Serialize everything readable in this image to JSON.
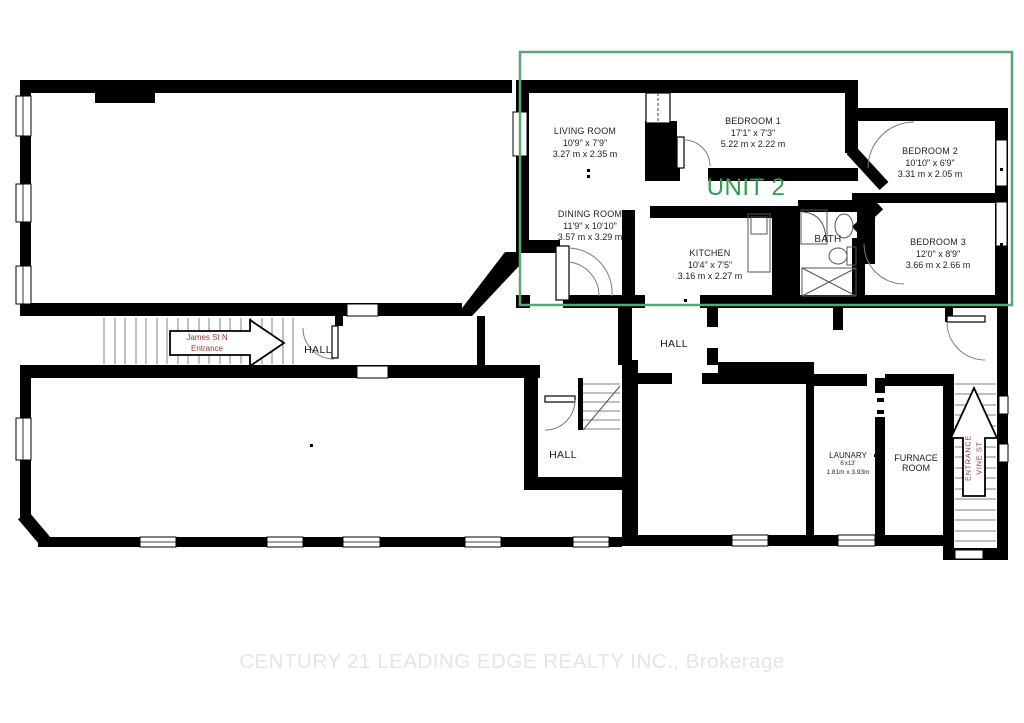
{
  "plan": {
    "unit_label": "UNIT 2",
    "watermark": "CENTURY 21 LEADING EDGE REALTY INC., Brokerage",
    "colors": {
      "walls": "#000000",
      "unit_outline": "#56a877",
      "unit_text": "#2f9e4e",
      "entrance_text": "#963d38",
      "watermark_text": "#e5e5e5"
    },
    "rooms": {
      "living": {
        "name": "LIVING ROOM",
        "dims_ft": "10'9\" x 7'9\"",
        "dims_m": "3.27 m x 2.35 m"
      },
      "bedroom1": {
        "name": "BEDROOM 1",
        "dims_ft": "17'1\" x 7'3\"",
        "dims_m": "5.22 m x 2.22 m"
      },
      "bedroom2": {
        "name": "BEDROOM 2",
        "dims_ft": "10'10\" x 6'9\"",
        "dims_m": "3.31 m x 2.05 m"
      },
      "bedroom3": {
        "name": "BEDROOM 3",
        "dims_ft": "12'0\" x 8'9\"",
        "dims_m": "3.66 m x 2.66 m"
      },
      "dining": {
        "name": "DINING ROOM",
        "dims_ft": "11'9\" x 10'10\"",
        "dims_m": "3.57 m x 3.29 m"
      },
      "kitchen": {
        "name": "KITCHEN",
        "dims_ft": "10'4\" x 7'5\"",
        "dims_m": "3.16 m x 2.27 m"
      },
      "bath": {
        "name": "BATH"
      },
      "hall_upper": {
        "name": "HALL"
      },
      "hall_middle": {
        "name": "HALL"
      },
      "hall_lower": {
        "name": "HALL"
      },
      "laundry": {
        "name": "LAUNARY",
        "dims_ft": "6'x13'",
        "dims_m": "1.81m x 3.93m"
      },
      "furnace": {
        "name": "FURNACE ROOM"
      }
    },
    "entrances": {
      "james": {
        "line1": "James St N",
        "line2": "Entrance"
      },
      "vine": {
        "line1": "VINE ST",
        "line2": "ENTRANCE"
      }
    }
  }
}
